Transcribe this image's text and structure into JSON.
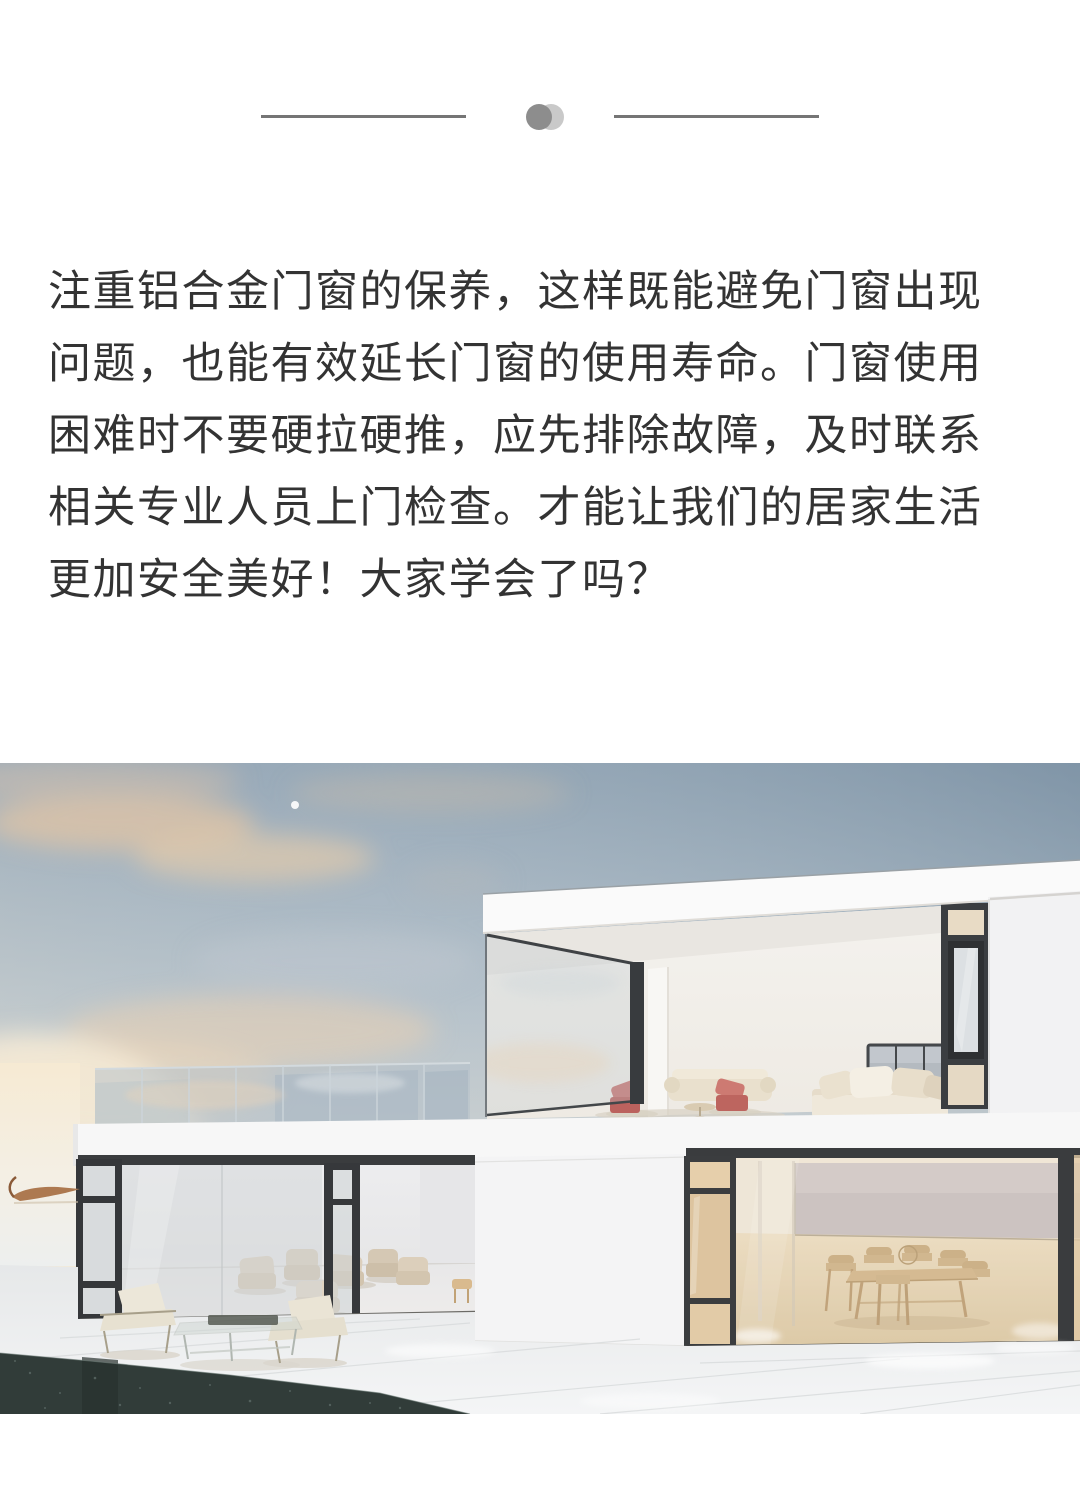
{
  "page": {
    "background_color": "#ffffff",
    "width": 1080,
    "height": 1499
  },
  "divider": {
    "line_color": "#757575",
    "dot_front_color": "#8d8d8d",
    "dot_back_color": "#c9c9c9"
  },
  "article": {
    "text_color": "#333333",
    "lines": [
      "注重铝合金门窗的保养，这样既能避免门窗出现",
      "问题，也能有效延长门窗的使用寿命。门窗使用",
      "困难时不要硬拉硬推，应先排除故障，及时联系",
      "相关专业人员上门检查。才能让我们的居家生活",
      "更加安全美好！大家学会了吗？"
    ]
  },
  "photo": {
    "alt": "Rendering of a modern two-storey white flat-roof house with black-framed floor-to-ceiling glazing, terrace lounge furniture, dining room, dark pool edge and a pastel sunset sky",
    "palette": {
      "sky_blue": "#8fa2b3",
      "cloud_peach": "#ecd0ae",
      "wall_white": "#f4f4f5",
      "frame_dark": "#383b3e",
      "glass_blue": "#c2ccd3",
      "interior_warm": "#e6d5ba",
      "furniture_beige": "#dbcfbc",
      "chair_red": "#c66f6a",
      "pool_dark": "#313c39"
    }
  }
}
